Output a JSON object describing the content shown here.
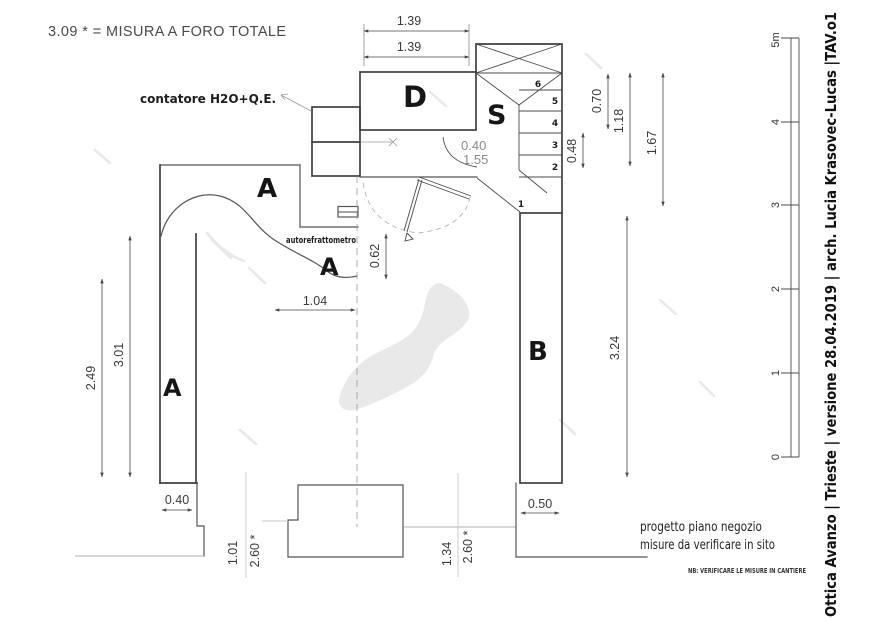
{
  "title": "3.09 * = MISURA A FORO TOTALE",
  "annotations": {
    "contatore": "contatore H2O+Q.E.",
    "autorefrattometro": "autorefrattometro"
  },
  "rooms": {
    "a_top": "A",
    "a_counter": "A",
    "a_left": "A",
    "b": "B",
    "d": "D",
    "s": "S"
  },
  "steps": [
    "1",
    "2",
    "3",
    "4",
    "5",
    "6"
  ],
  "dimensions": {
    "top_outer": "1.39",
    "top_inner": "1.39",
    "door_width": "0.40",
    "door_height": "1.55",
    "counter_depth": "0.62",
    "counter_width": "1.04",
    "stair_048": "0.48",
    "right_070": "0.70",
    "right_118": "1.18",
    "right_167": "1.67",
    "right_324": "3.24",
    "left_301": "3.01",
    "left_249": "2.49",
    "pillar_left": "0.40",
    "pillar_right": "0.50",
    "win_left_w": "1.01",
    "win_left_h": "2.60 *",
    "win_right_w": "1.34",
    "win_right_h": "2.60 *"
  },
  "scalebar": {
    "labels": [
      "0",
      "1",
      "2",
      "3",
      "4",
      "5m"
    ]
  },
  "titleblock": "Ottica Avanzo | Trieste | versione 28.04.2019 | arch. Lucia Krasovec-Lucas |TAV.o1",
  "notes": {
    "line1": "progetto piano negozio",
    "line2": "misure da verificare in sito",
    "nb": "NB: VERIFICARE LE MISURE IN CANTIERE"
  },
  "colors": {
    "wall": "#3f3f3f",
    "dim": "#474747",
    "aux_gray": "#999999",
    "light_gray": "#c7c7c7",
    "blob": "#e9e9e9",
    "text": "#222222"
  }
}
